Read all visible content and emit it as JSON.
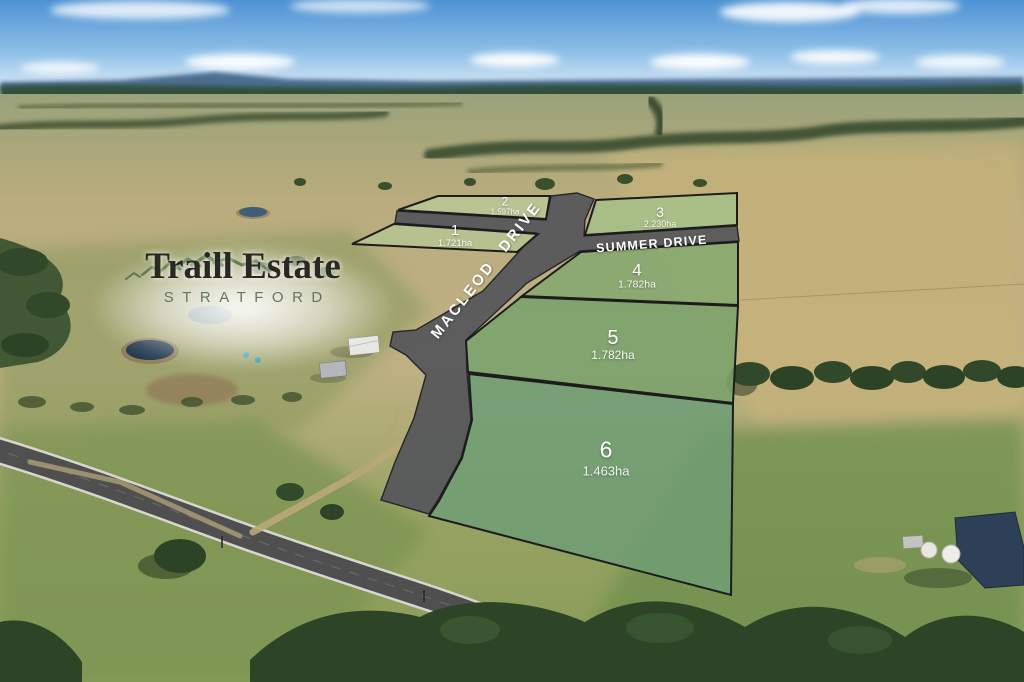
{
  "logo": {
    "title": "Traill Estate",
    "subtitle": "STRATFORD"
  },
  "roads": {
    "macleod": {
      "label": "MACLEOD DRIVE"
    },
    "summer": {
      "label": "SUMMER DRIVE"
    }
  },
  "lots": [
    {
      "number": "1",
      "area": "1.721ha",
      "fill": "#b6c492"
    },
    {
      "number": "2",
      "area": "1.597ha",
      "fill": "#bac795"
    },
    {
      "number": "3",
      "area": "2.230ha",
      "fill": "#a6c089"
    },
    {
      "number": "4",
      "area": "1.782ha",
      "fill": "#85a970"
    },
    {
      "number": "5",
      "area": "1.782ha",
      "fill": "#7aa26b"
    },
    {
      "number": "6",
      "area": "1.463ha",
      "fill": "#6f9d74"
    }
  ],
  "colors": {
    "road_overlay": "#55565a",
    "lot_stroke": "#1c1c1c",
    "label_text": "#ffffff",
    "logo_title": "#292823",
    "logo_subtitle": "#64755f",
    "logo_mountains": "#5e7b50",
    "sky": "#5b9bd8",
    "dry_paddock": "#bfae7e",
    "green_paddock": "#7e9552"
  }
}
